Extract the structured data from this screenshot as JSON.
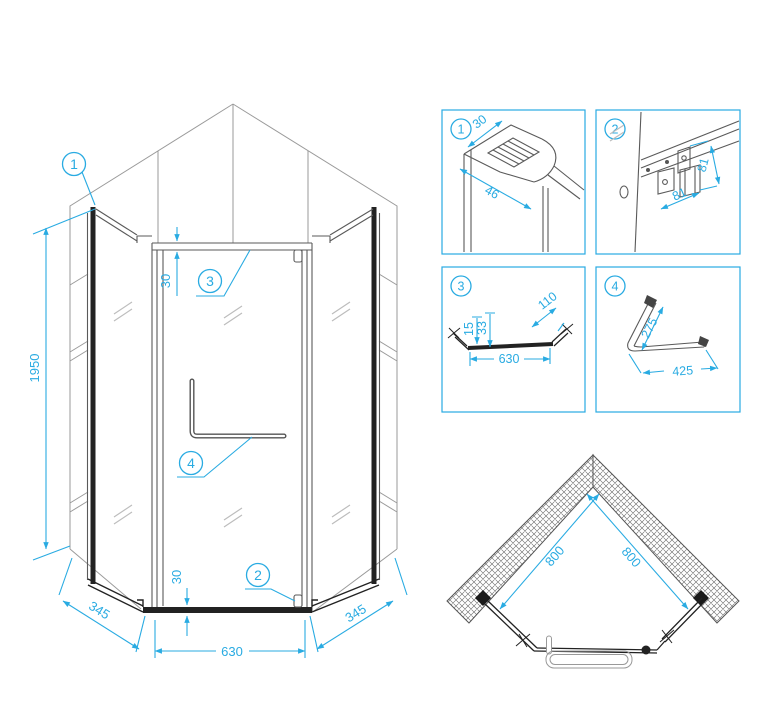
{
  "drawing": {
    "accent_color": "#29abe2",
    "line_color": "#5a5a5a",
    "dark_color": "#222222"
  },
  "main": {
    "callout_1": "1",
    "callout_2": "2",
    "callout_3": "3",
    "callout_4": "4",
    "dim_height": "1950",
    "dim_top_profile": "30",
    "dim_bottom_profile": "30",
    "dim_side_left": "345",
    "dim_door": "630",
    "dim_side_right": "345"
  },
  "detail_1": {
    "label": "1",
    "dim_width": "30",
    "dim_depth": "46"
  },
  "detail_2": {
    "label": "2",
    "dim_upper": "81",
    "dim_lower": "81"
  },
  "detail_3": {
    "label": "3",
    "dim_profile": "15",
    "dim_total": "33",
    "dim_end": "110",
    "dim_length": "630"
  },
  "detail_4": {
    "label": "4",
    "dim_short": "275",
    "dim_long": "425"
  },
  "plan": {
    "dim_wall_left": "800",
    "dim_wall_right": "800"
  }
}
